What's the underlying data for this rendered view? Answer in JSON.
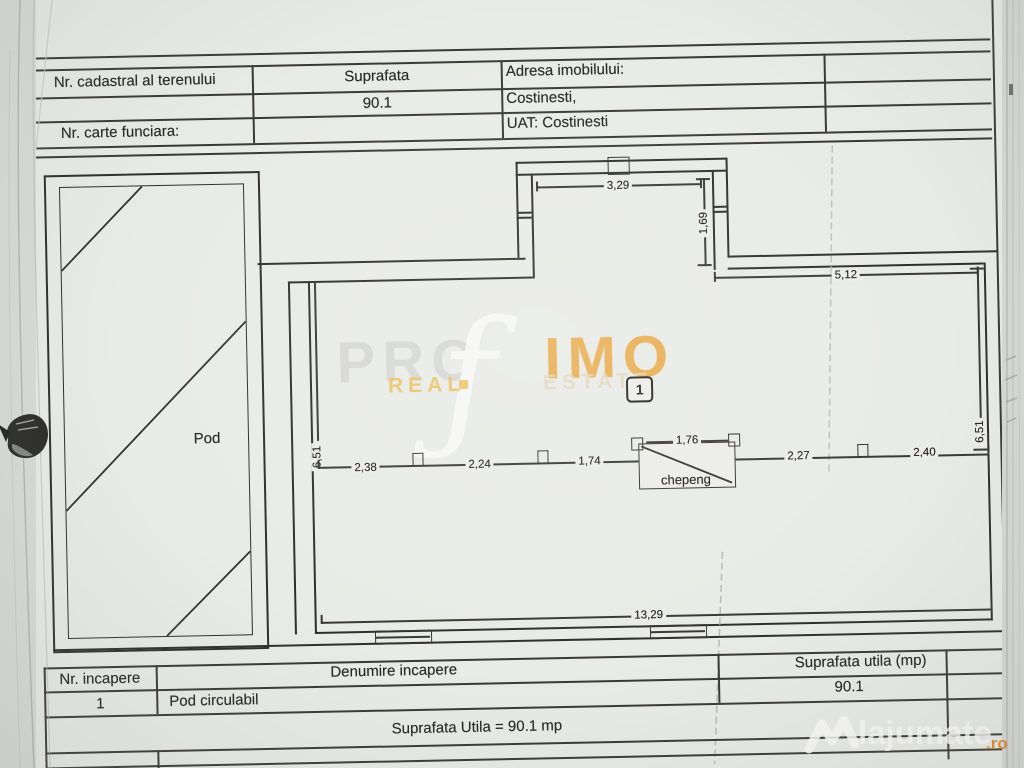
{
  "header_table": {
    "nr_cadastral_label": "Nr. cadastral al terenului",
    "suprafata_label": "Suprafata",
    "adresa_label": "Adresa imobilului:",
    "suprafata_value": "90.1",
    "adresa_value": "Costinesti,",
    "carte_funciara_label": "Nr. carte funciara:",
    "uat_value": "UAT: Costinesti"
  },
  "plan": {
    "room_label": "Pod",
    "room_number": "1",
    "hatch_label": "chepeng",
    "dimensions": {
      "bay_width": "3,29",
      "bay_return": "1,69",
      "top_right_width": "5,12",
      "left_height": "6,51",
      "right_height": "6,51",
      "seg_1": "2,38",
      "seg_2": "2,24",
      "seg_3": "1,74",
      "hatch_width": "1,76",
      "seg_4": "2,27",
      "seg_5": "2,40",
      "total_width": "13,29"
    }
  },
  "room_table": {
    "nr_incapere_label": "Nr. incapere",
    "denumire_label": "Denumire incapere",
    "suprafata_utila_label": "Suprafata utila (mp)",
    "row": {
      "nr": "1",
      "name": "Pod circulabil",
      "area": "90.1"
    },
    "total": "Suprafata Utila = 90.1 mp"
  },
  "watermark": {
    "part1": "PRO",
    "script_letter": "ƒ",
    "part2": "IMO",
    "sub1": "REAL",
    "sub2": "ESTATE"
  },
  "logo": {
    "name": "lajumate",
    "tld": ".ro"
  },
  "colors": {
    "paper": "#e9ebe7",
    "ink": "#3a3833",
    "watermark_orange": "#e9a53c",
    "logo_orange": "#e2801a"
  }
}
